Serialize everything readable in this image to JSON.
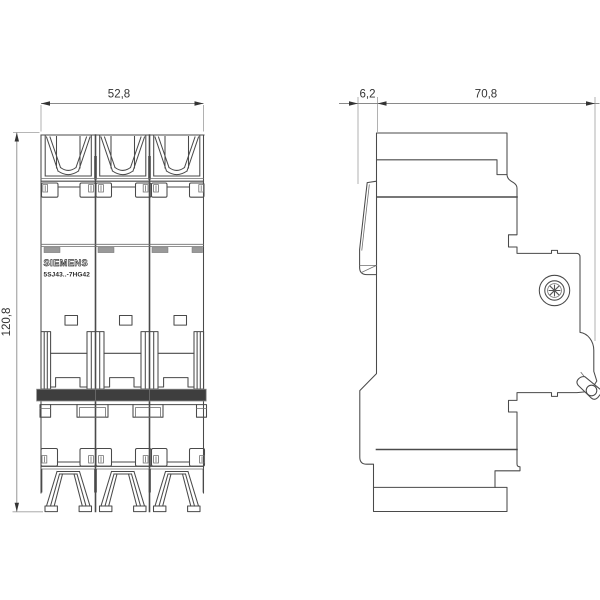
{
  "views": {
    "front": {
      "brand": "SIEMENS",
      "model": "5SJ43..-7HG42",
      "width_mm": "52,8",
      "height_mm": "120,8"
    },
    "side": {
      "front_protrusion_mm": "6,2",
      "depth_mm": "70,8"
    }
  },
  "colors": {
    "line": "#4a4a4a",
    "dim_line": "#8a8a8a",
    "extension_line": "#9e9e9e",
    "text": "#333333",
    "tie_bar": "#3e3e3e",
    "tab_gray": "#999999",
    "background": "#ffffff"
  }
}
